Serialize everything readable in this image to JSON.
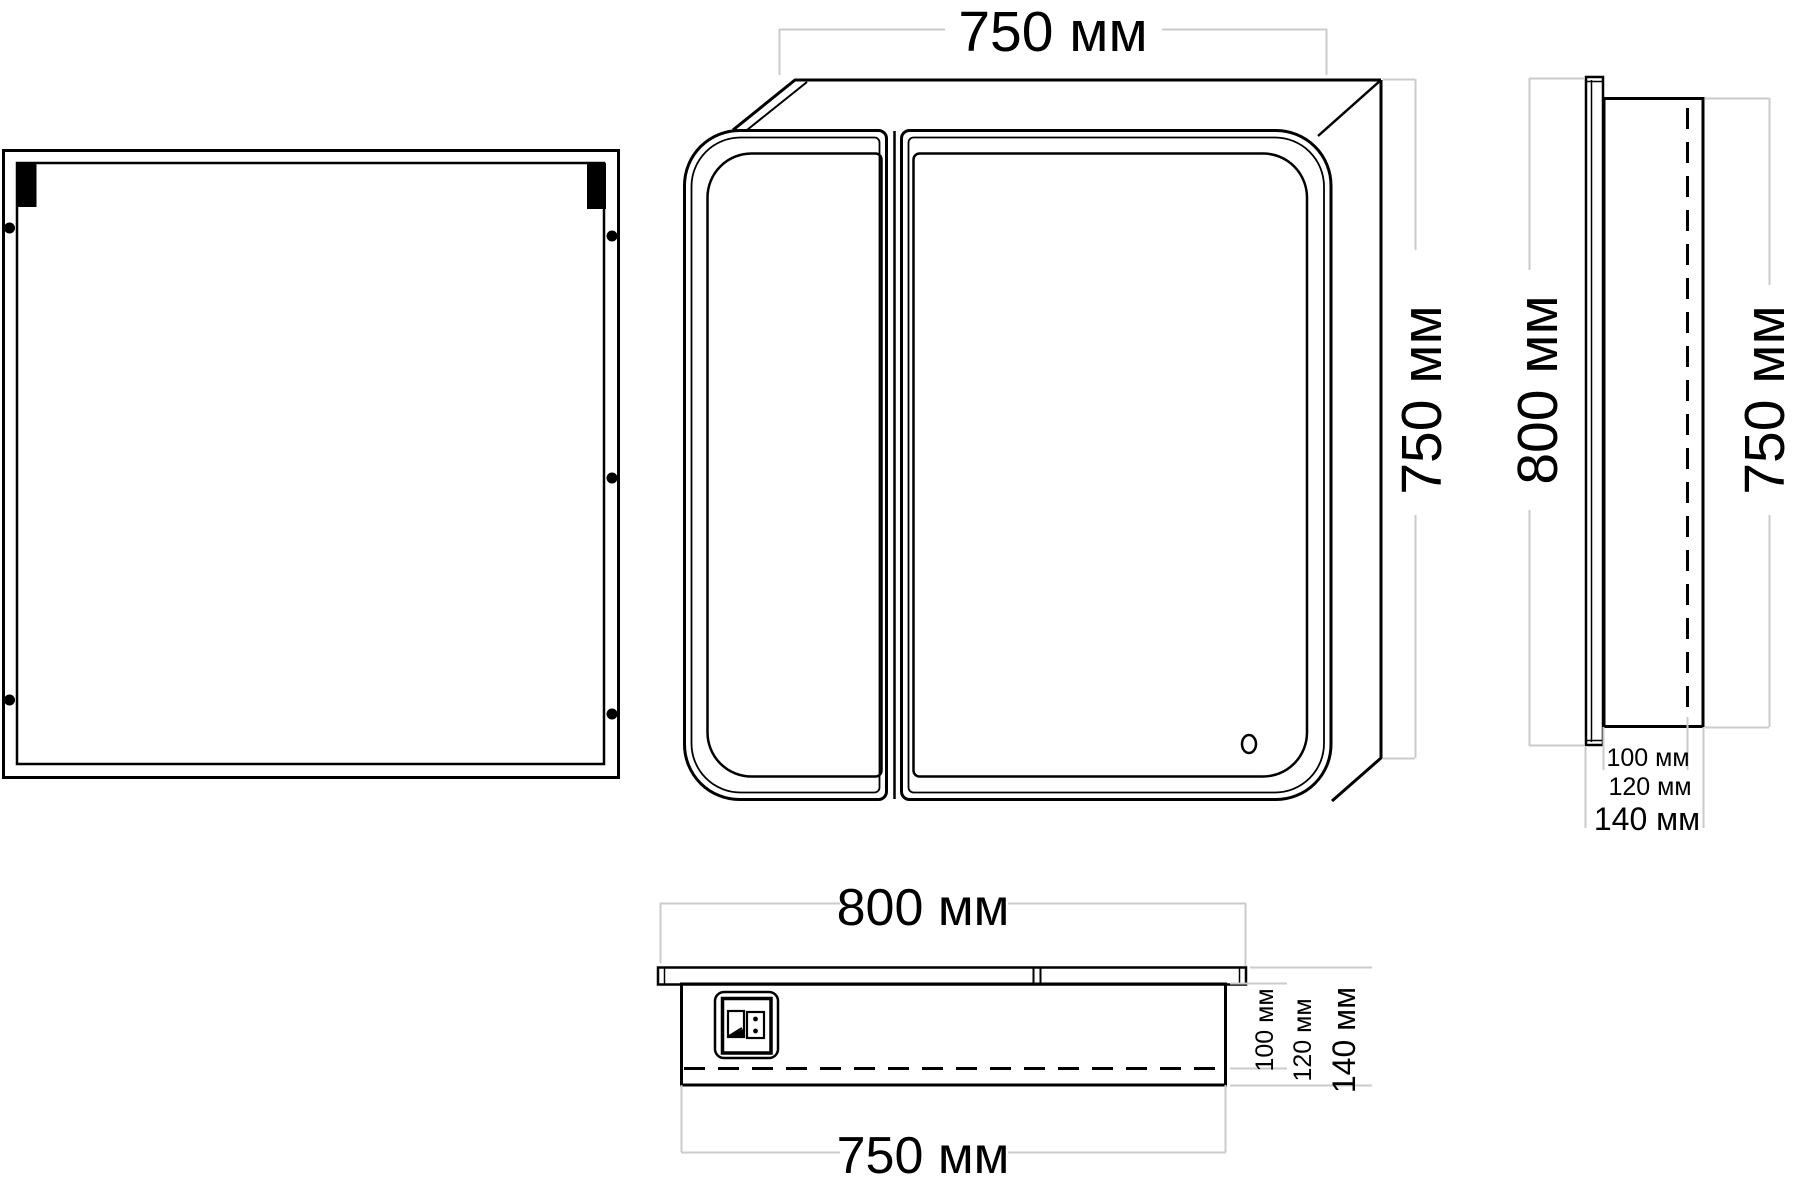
{
  "drawing": {
    "colors": {
      "line": "#000000",
      "dimension_line": "#cbcbcb",
      "background": "#ffffff"
    },
    "front_view": {
      "width": "750 мм",
      "height": "750 мм"
    },
    "side_view": {
      "door_height": "800 мм",
      "body_height": "750 мм",
      "depths": [
        "100 мм",
        "120 мм",
        "140 мм"
      ]
    },
    "bottom_view": {
      "overall_width": "800 мм",
      "body_width": "750 мм",
      "depths": [
        "100 мм",
        "120 мм",
        "140 мм"
      ]
    }
  }
}
